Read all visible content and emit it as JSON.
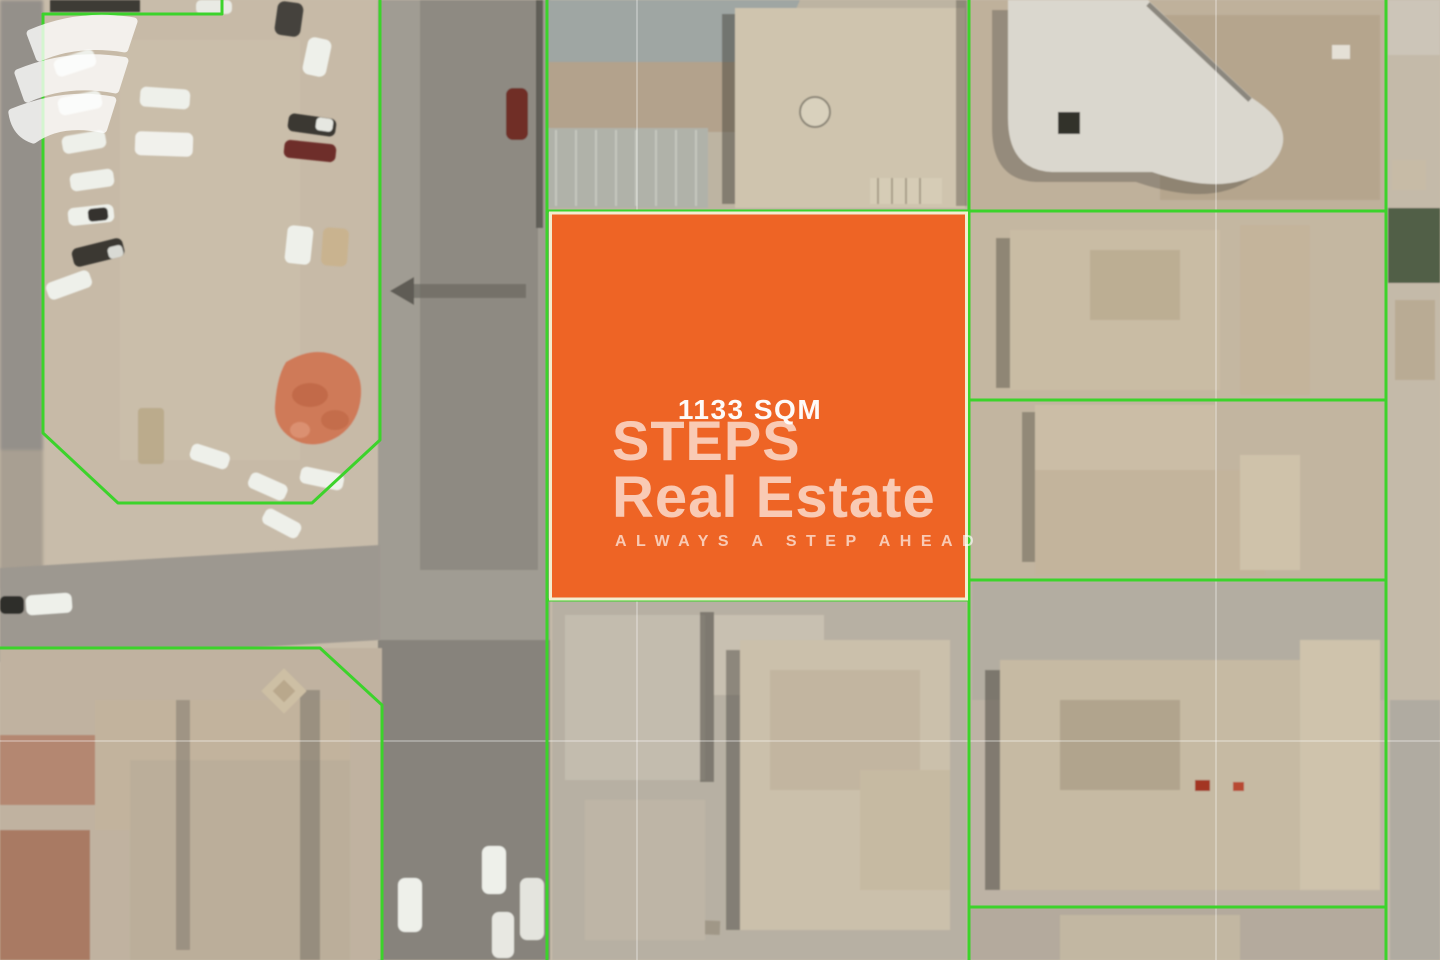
{
  "map": {
    "plot": {
      "area_label": "1133 SQM"
    },
    "colors": {
      "plot_fill": "#EE6425",
      "plot_border": "#F3ECCF",
      "boundary_green": "#3CD32B",
      "watermark": "#FFFFFF"
    }
  },
  "watermark": {
    "logo_icon": "steps-swoosh-icon",
    "brand_name": "STEPS",
    "brand_suffix": "Real Estate",
    "tagline": "ALWAYS A STEP AHEAD"
  }
}
